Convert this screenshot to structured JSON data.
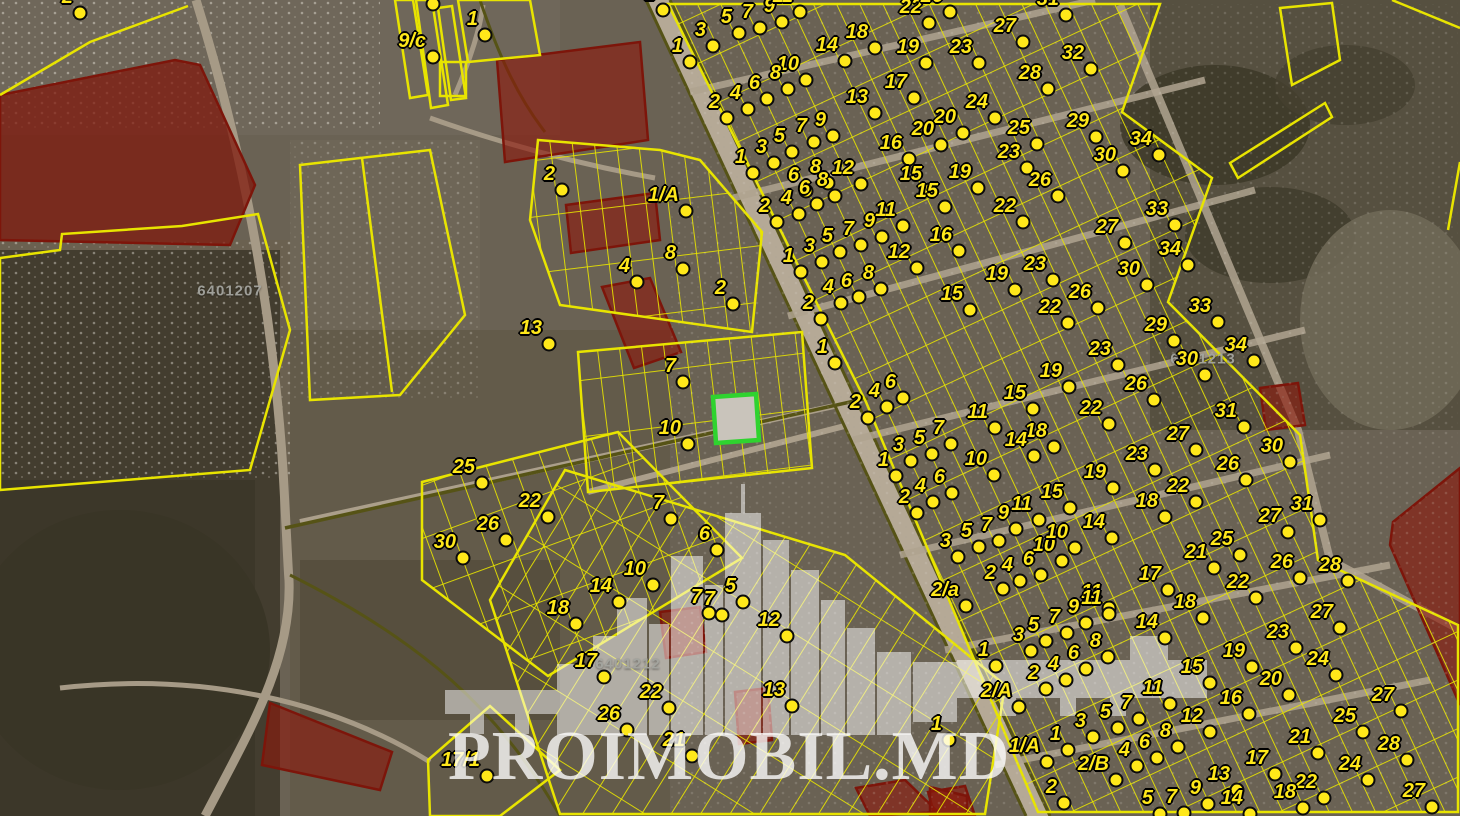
{
  "app": {
    "title": "Satellite cadastral map with land parcels"
  },
  "watermark": {
    "text": "PROIMOBIL.MD"
  },
  "cadastral_labels": [
    {
      "x": 230,
      "y": 291,
      "text": "6401207"
    },
    {
      "x": 628,
      "y": 664,
      "text": "6401212"
    },
    {
      "x": 1203,
      "y": 359,
      "text": "6401213"
    }
  ],
  "colors": {
    "parcel_line": "#e8e400",
    "marker_fill": "#ffe81a",
    "highlight": "#2fd32f",
    "restricted_fill": "rgba(140,25,12,0.62)",
    "road": "#b5a996"
  },
  "markers": [
    [
      80,
      13,
      "2"
    ],
    [
      433,
      4,
      ""
    ],
    [
      485,
      35,
      "1"
    ],
    [
      433,
      57,
      "9/c"
    ],
    [
      562,
      190,
      "2"
    ],
    [
      663,
      10,
      "2"
    ],
    [
      690,
      62,
      "1"
    ],
    [
      686,
      211,
      "1/A"
    ],
    [
      683,
      269,
      "8"
    ],
    [
      637,
      282,
      "4"
    ],
    [
      733,
      304,
      "2"
    ],
    [
      549,
      344,
      "13"
    ],
    [
      683,
      382,
      "7"
    ],
    [
      688,
      444,
      "10"
    ],
    [
      482,
      483,
      "25"
    ],
    [
      548,
      517,
      "22"
    ],
    [
      506,
      540,
      "26"
    ],
    [
      463,
      558,
      "30"
    ],
    [
      671,
      519,
      "7"
    ],
    [
      717,
      550,
      "6"
    ],
    [
      653,
      585,
      "10"
    ],
    [
      619,
      602,
      "14"
    ],
    [
      576,
      624,
      "18"
    ],
    [
      709,
      613,
      "7"
    ],
    [
      743,
      602,
      "5"
    ],
    [
      722,
      615,
      "7"
    ],
    [
      787,
      636,
      "12"
    ],
    [
      604,
      677,
      "17"
    ],
    [
      669,
      708,
      "22"
    ],
    [
      627,
      730,
      "26"
    ],
    [
      692,
      756,
      "21"
    ],
    [
      792,
      706,
      "13"
    ],
    [
      487,
      776,
      "17/1"
    ],
    [
      713,
      46,
      "3"
    ],
    [
      739,
      33,
      "5"
    ],
    [
      760,
      28,
      "7"
    ],
    [
      782,
      22,
      "9"
    ],
    [
      800,
      12,
      "11"
    ],
    [
      806,
      80,
      "10"
    ],
    [
      845,
      61,
      "14"
    ],
    [
      875,
      48,
      "18"
    ],
    [
      929,
      23,
      "22"
    ],
    [
      950,
      12,
      "26"
    ],
    [
      926,
      63,
      "19"
    ],
    [
      979,
      63,
      "23"
    ],
    [
      1023,
      42,
      "27"
    ],
    [
      1066,
      15,
      "31"
    ],
    [
      1091,
      69,
      "32"
    ],
    [
      1048,
      89,
      "28"
    ],
    [
      995,
      118,
      "24"
    ],
    [
      963,
      133,
      "20"
    ],
    [
      1037,
      144,
      "25"
    ],
    [
      1096,
      137,
      "29"
    ],
    [
      1027,
      168,
      "23"
    ],
    [
      1159,
      155,
      "34"
    ],
    [
      1123,
      171,
      "30"
    ],
    [
      978,
      188,
      "19"
    ],
    [
      1058,
      196,
      "26"
    ],
    [
      727,
      118,
      "2"
    ],
    [
      748,
      109,
      "4"
    ],
    [
      767,
      99,
      "6"
    ],
    [
      788,
      89,
      "8"
    ],
    [
      753,
      173,
      "1"
    ],
    [
      774,
      163,
      "3"
    ],
    [
      792,
      152,
      "5"
    ],
    [
      814,
      142,
      "7"
    ],
    [
      833,
      136,
      "9"
    ],
    [
      875,
      113,
      "13"
    ],
    [
      914,
      98,
      "17"
    ],
    [
      861,
      184,
      "12"
    ],
    [
      909,
      159,
      "16"
    ],
    [
      941,
      145,
      "20"
    ],
    [
      806,
      191,
      "6"
    ],
    [
      828,
      183,
      "8"
    ],
    [
      929,
      190,
      "15"
    ],
    [
      777,
      222,
      "2"
    ],
    [
      799,
      214,
      "4"
    ],
    [
      817,
      204,
      "6"
    ],
    [
      835,
      196,
      "8"
    ],
    [
      801,
      272,
      "1"
    ],
    [
      822,
      262,
      "3"
    ],
    [
      840,
      252,
      "5"
    ],
    [
      861,
      245,
      "7"
    ],
    [
      882,
      237,
      "9"
    ],
    [
      903,
      226,
      "11"
    ],
    [
      945,
      207,
      "15"
    ],
    [
      1023,
      222,
      "22"
    ],
    [
      1053,
      280,
      "23"
    ],
    [
      917,
      268,
      "12"
    ],
    [
      959,
      251,
      "16"
    ],
    [
      1015,
      290,
      "19"
    ],
    [
      970,
      310,
      "15"
    ],
    [
      841,
      303,
      "4"
    ],
    [
      859,
      297,
      "6"
    ],
    [
      881,
      289,
      "8"
    ],
    [
      821,
      319,
      "2"
    ],
    [
      835,
      363,
      "1"
    ],
    [
      1068,
      323,
      "22"
    ],
    [
      1175,
      225,
      "33"
    ],
    [
      1125,
      243,
      "27"
    ],
    [
      1188,
      265,
      "34"
    ],
    [
      1147,
      285,
      "30"
    ],
    [
      1098,
      308,
      "26"
    ],
    [
      1218,
      322,
      "33"
    ],
    [
      1174,
      341,
      "29"
    ],
    [
      1118,
      365,
      "23"
    ],
    [
      1254,
      361,
      "34"
    ],
    [
      1205,
      375,
      "30"
    ],
    [
      1154,
      400,
      "26"
    ],
    [
      1069,
      387,
      "19"
    ],
    [
      868,
      418,
      "2"
    ],
    [
      887,
      407,
      "4"
    ],
    [
      903,
      398,
      "6"
    ],
    [
      951,
      444,
      "7"
    ],
    [
      932,
      454,
      "5"
    ],
    [
      911,
      461,
      "3"
    ],
    [
      896,
      476,
      "1"
    ],
    [
      995,
      428,
      "11"
    ],
    [
      1033,
      409,
      "15"
    ],
    [
      1054,
      447,
      "18"
    ],
    [
      1034,
      456,
      "14"
    ],
    [
      994,
      475,
      "10"
    ],
    [
      952,
      493,
      "6"
    ],
    [
      933,
      502,
      "4"
    ],
    [
      917,
      513,
      "2"
    ],
    [
      1070,
      508,
      "15"
    ],
    [
      1039,
      520,
      "11"
    ],
    [
      1016,
      529,
      "9"
    ],
    [
      999,
      541,
      "7"
    ],
    [
      979,
      547,
      "5"
    ],
    [
      958,
      557,
      "3"
    ],
    [
      1062,
      561,
      "10"
    ],
    [
      1041,
      575,
      "6"
    ],
    [
      1020,
      581,
      "4"
    ],
    [
      1003,
      589,
      "2"
    ],
    [
      966,
      606,
      "2/a"
    ],
    [
      1109,
      424,
      "22"
    ],
    [
      1244,
      427,
      "31"
    ],
    [
      1196,
      450,
      "27"
    ],
    [
      1155,
      470,
      "23"
    ],
    [
      1290,
      462,
      "30"
    ],
    [
      1246,
      480,
      "26"
    ],
    [
      1113,
      488,
      "19"
    ],
    [
      1196,
      502,
      "22"
    ],
    [
      1165,
      517,
      "18"
    ],
    [
      1112,
      538,
      "14"
    ],
    [
      1075,
      548,
      "10"
    ],
    [
      1288,
      532,
      "27"
    ],
    [
      1240,
      555,
      "25"
    ],
    [
      1214,
      568,
      "21"
    ],
    [
      1168,
      590,
      "17"
    ],
    [
      1300,
      578,
      "26"
    ],
    [
      1256,
      598,
      "22"
    ],
    [
      1203,
      618,
      "18"
    ],
    [
      1109,
      608,
      "11"
    ],
    [
      1320,
      520,
      "31"
    ],
    [
      1348,
      581,
      "28"
    ],
    [
      996,
      666,
      "1"
    ],
    [
      1031,
      651,
      "3"
    ],
    [
      1046,
      641,
      "5"
    ],
    [
      1067,
      633,
      "7"
    ],
    [
      1086,
      623,
      "9"
    ],
    [
      1109,
      614,
      "11"
    ],
    [
      1086,
      669,
      "6"
    ],
    [
      1108,
      657,
      "8"
    ],
    [
      1066,
      680,
      "4"
    ],
    [
      1046,
      689,
      "2"
    ],
    [
      1019,
      707,
      "2/A"
    ],
    [
      949,
      740,
      "1"
    ],
    [
      1047,
      762,
      "1/A"
    ],
    [
      1068,
      750,
      "1"
    ],
    [
      1093,
      737,
      "3"
    ],
    [
      1118,
      728,
      "5"
    ],
    [
      1139,
      719,
      "7"
    ],
    [
      1116,
      780,
      "2/B"
    ],
    [
      1137,
      766,
      "4"
    ],
    [
      1157,
      758,
      "6"
    ],
    [
      1064,
      803,
      "2"
    ],
    [
      1165,
      638,
      "14"
    ],
    [
      1340,
      628,
      "27"
    ],
    [
      1296,
      648,
      "23"
    ],
    [
      1252,
      667,
      "19"
    ],
    [
      1210,
      683,
      "15"
    ],
    [
      1336,
      675,
      "24"
    ],
    [
      1289,
      695,
      "20"
    ],
    [
      1170,
      704,
      "11"
    ],
    [
      1249,
      714,
      "16"
    ],
    [
      1210,
      732,
      "12"
    ],
    [
      1401,
      711,
      "27"
    ],
    [
      1363,
      732,
      "25"
    ],
    [
      1318,
      753,
      "21"
    ],
    [
      1178,
      747,
      "8"
    ],
    [
      1275,
      774,
      "17"
    ],
    [
      1368,
      780,
      "24"
    ],
    [
      1237,
      790,
      "13"
    ],
    [
      1324,
      798,
      "22"
    ],
    [
      1208,
      804,
      "9"
    ],
    [
      1184,
      813,
      "7"
    ],
    [
      1303,
      808,
      "18"
    ],
    [
      1160,
      814,
      "5"
    ],
    [
      1250,
      814,
      "14"
    ],
    [
      1407,
      760,
      "28"
    ],
    [
      1432,
      807,
      "27"
    ]
  ]
}
